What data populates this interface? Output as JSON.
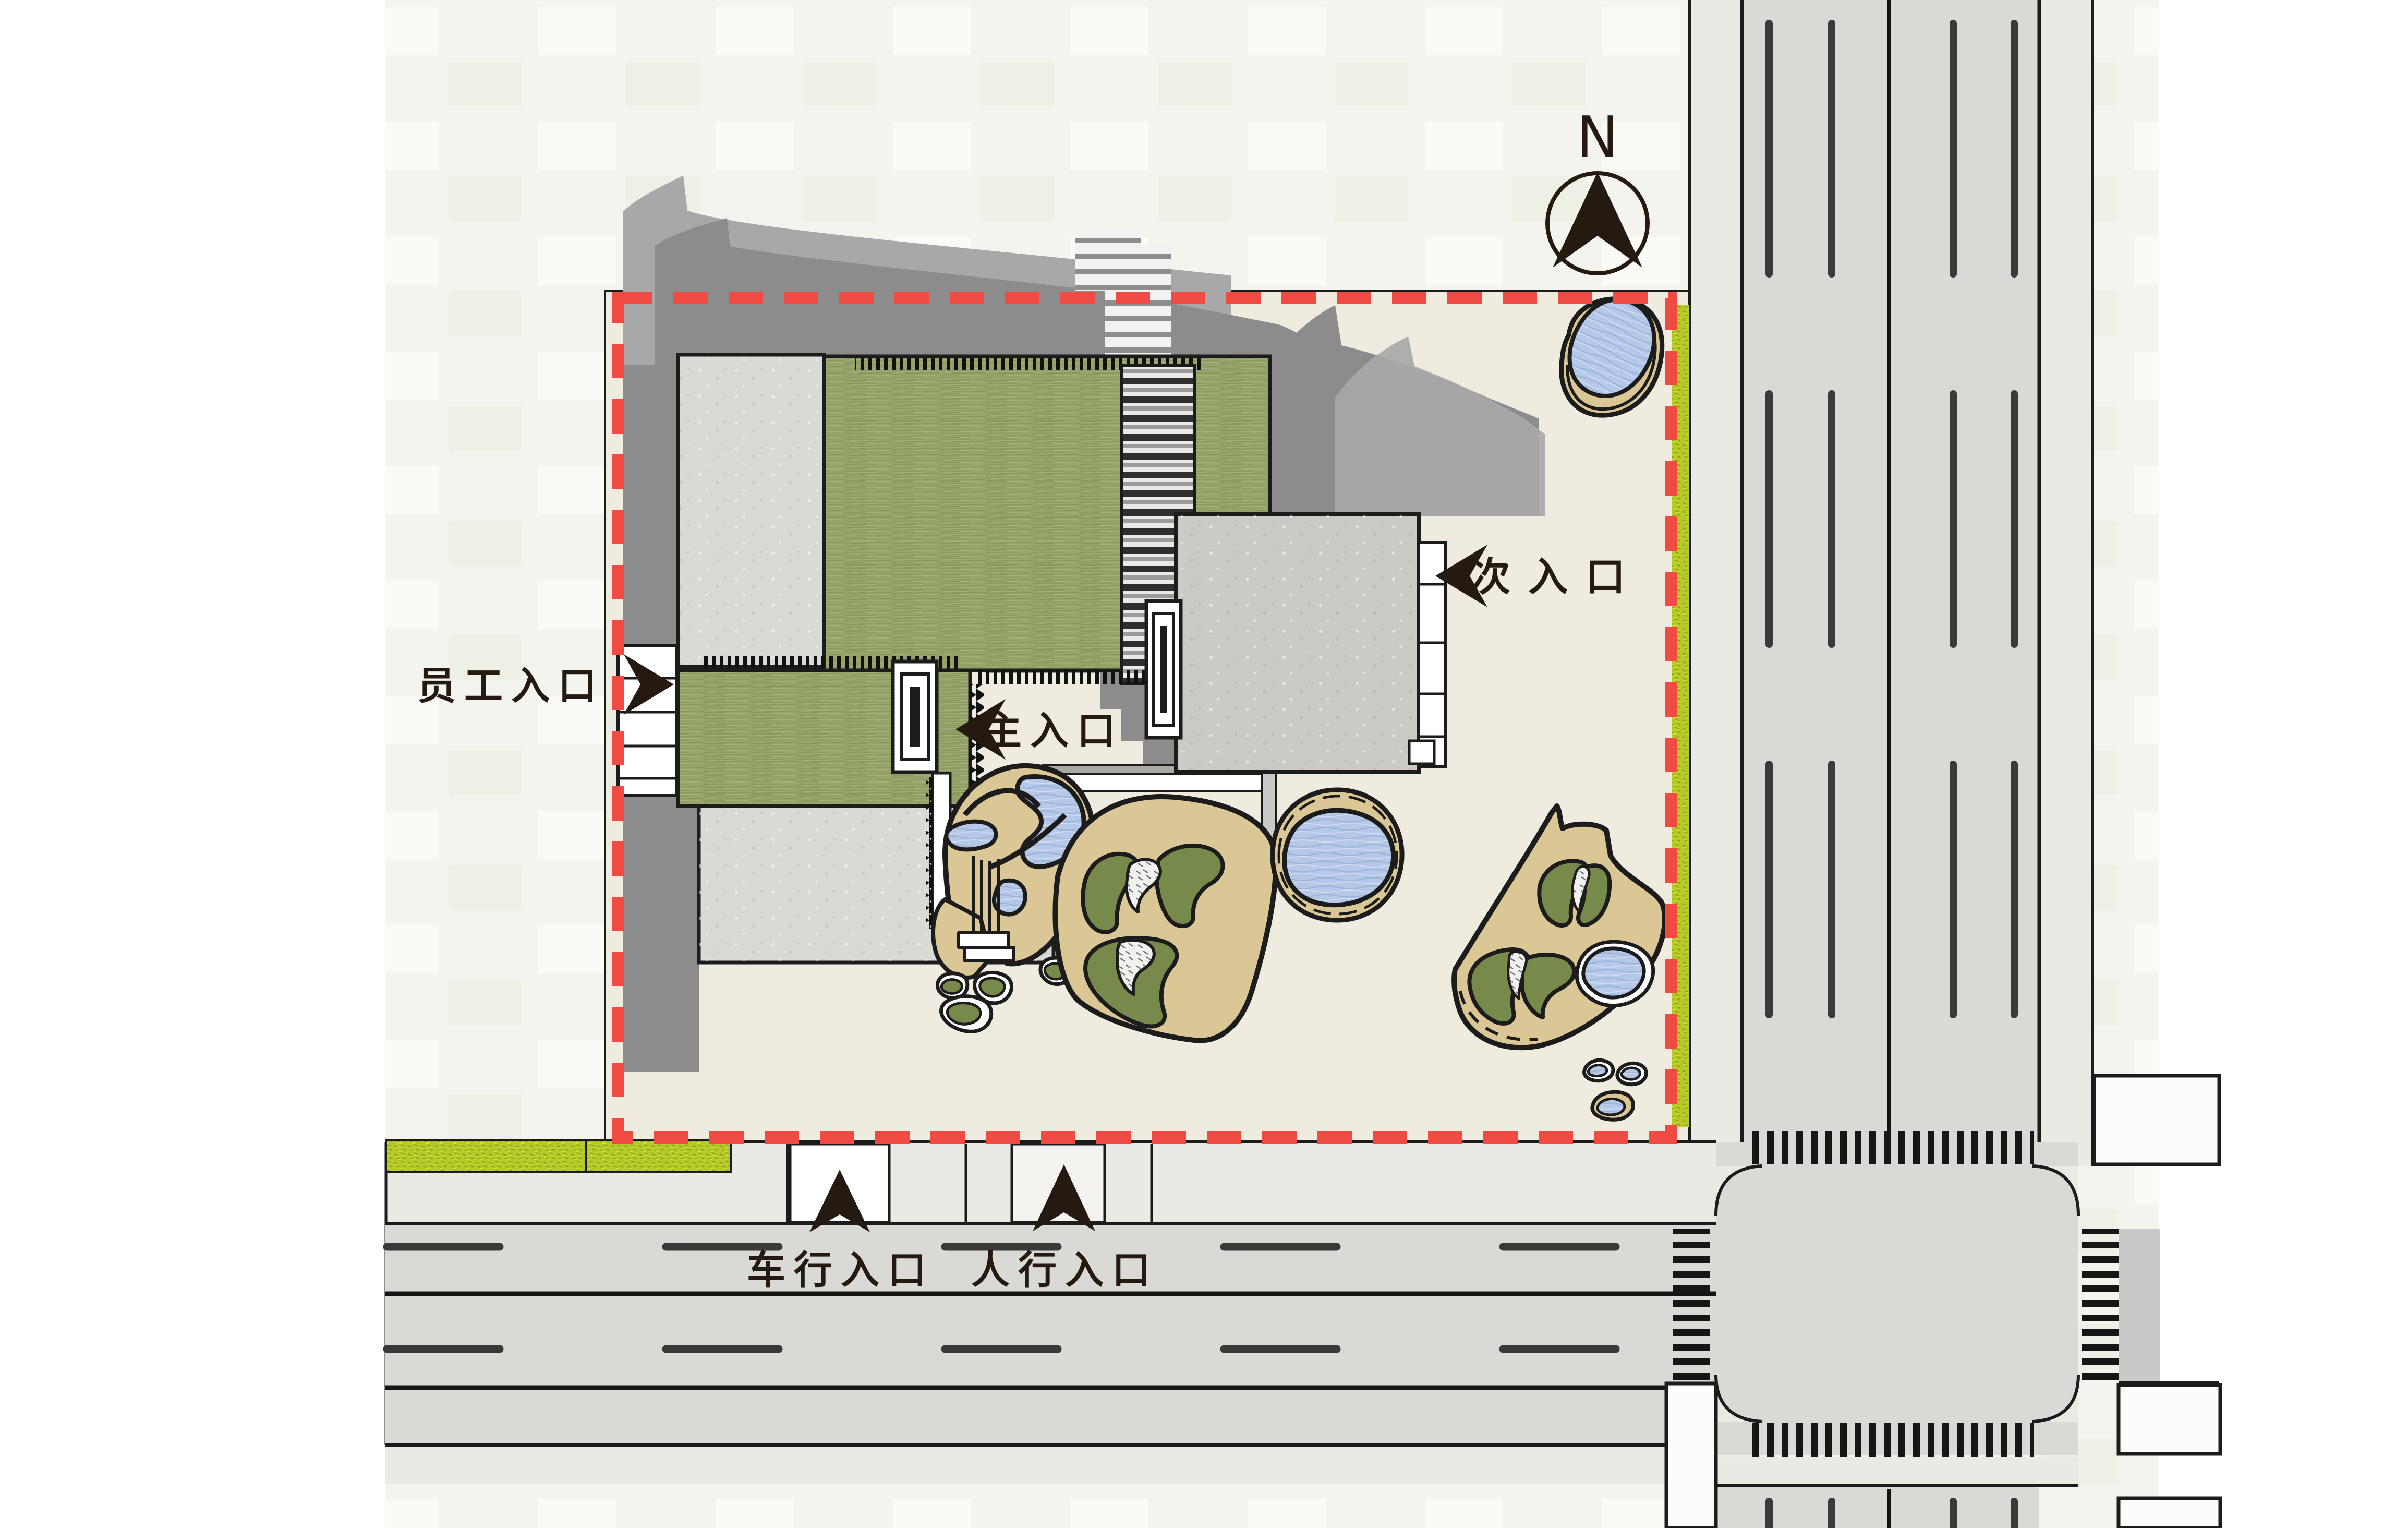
{
  "title": "site-plan",
  "compass": {
    "north_letter": "N"
  },
  "labels": {
    "staff_entrance": "员工入口",
    "main_entrance": "主入口",
    "secondary_entrance": "次入口",
    "vehicle_entrance": "车行入口",
    "pedestrian_entrance": "人行入口"
  },
  "colors": {
    "boundary_red": "#EF4A43",
    "roof_green": "#97A46B",
    "roof_green_streak": "#7E8F55",
    "roof_gray": "#D9D9D5",
    "building_gray": "#CBCAC5",
    "shadow_gray": "#8C8C8C",
    "shadow_gray_light": "#A8A8A8",
    "site_beige": "#EFECDF",
    "sand": "#DBC795",
    "water_blue": "#B6C8E8",
    "planting_green": "#77894B",
    "hedge_green": "#B7CA28",
    "road_gray": "#D9D9D6",
    "sidewalk_gray": "#EAE9E4",
    "bg_pale": "#F2F4ED",
    "outline_dark": "#1C1C1C",
    "label_dark": "#241A12",
    "lane_dash": "#3A3A3A"
  }
}
